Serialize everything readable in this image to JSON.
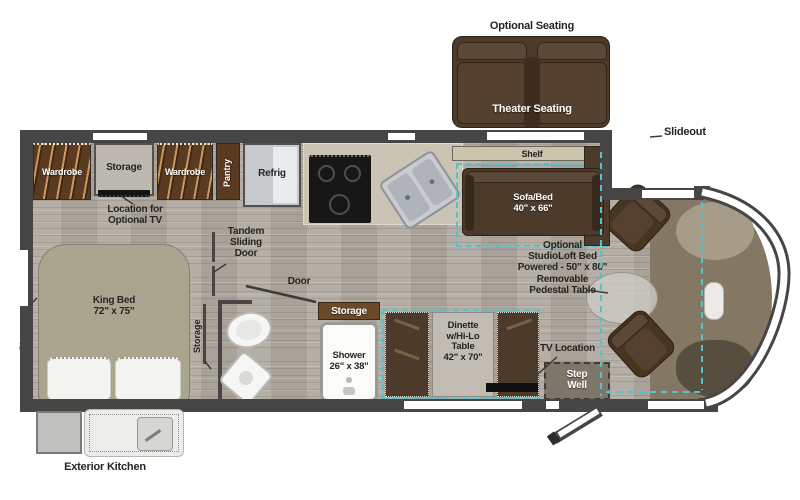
{
  "colors": {
    "wall": "#474645",
    "accent_teal": "#4fc3d4",
    "furniture_brown": "#4c3a2b",
    "cabinet_wood": "#5a3a21",
    "bed_sage": "#a9a58f",
    "counter_beige": "#c9c4b4"
  },
  "optional_seating": {
    "label": "Optional Seating",
    "seat_label": "Theater Seating"
  },
  "annotations": {
    "slideout": "Slideout",
    "location_for_optional_tv": "Location for\nOptional TV",
    "tandem_sliding_door": "Tandem\nSliding\nDoor",
    "door": "Door",
    "studioloft": "Optional\nStudioLoft Bed\nPowered - 50\" x 80\"\nRemovable\nPedestal Table",
    "tv_location": "TV Location",
    "exterior_kitchen": "Exterior Kitchen"
  },
  "cabinets": {
    "wardrobe_left": "Wardrobe",
    "storage": "Storage",
    "wardrobe_right": "Wardrobe",
    "pantry": "Pantry",
    "refrig": "Refrig"
  },
  "living": {
    "shelf": "Shelf",
    "sofa_bed": "Sofa/Bed\n40\" x 66\"",
    "dinette": "Dinette\nw/Hi-Lo\nTable\n42\" x 70\"",
    "step_well": "Step\nWell"
  },
  "bedroom": {
    "king_bed": "King Bed\n72\" x 75\"",
    "storage_wall": "Storage",
    "storage_divider": "Storage"
  },
  "bath": {
    "storage": "Storage",
    "shower": "Shower\n26\" x 38\""
  }
}
